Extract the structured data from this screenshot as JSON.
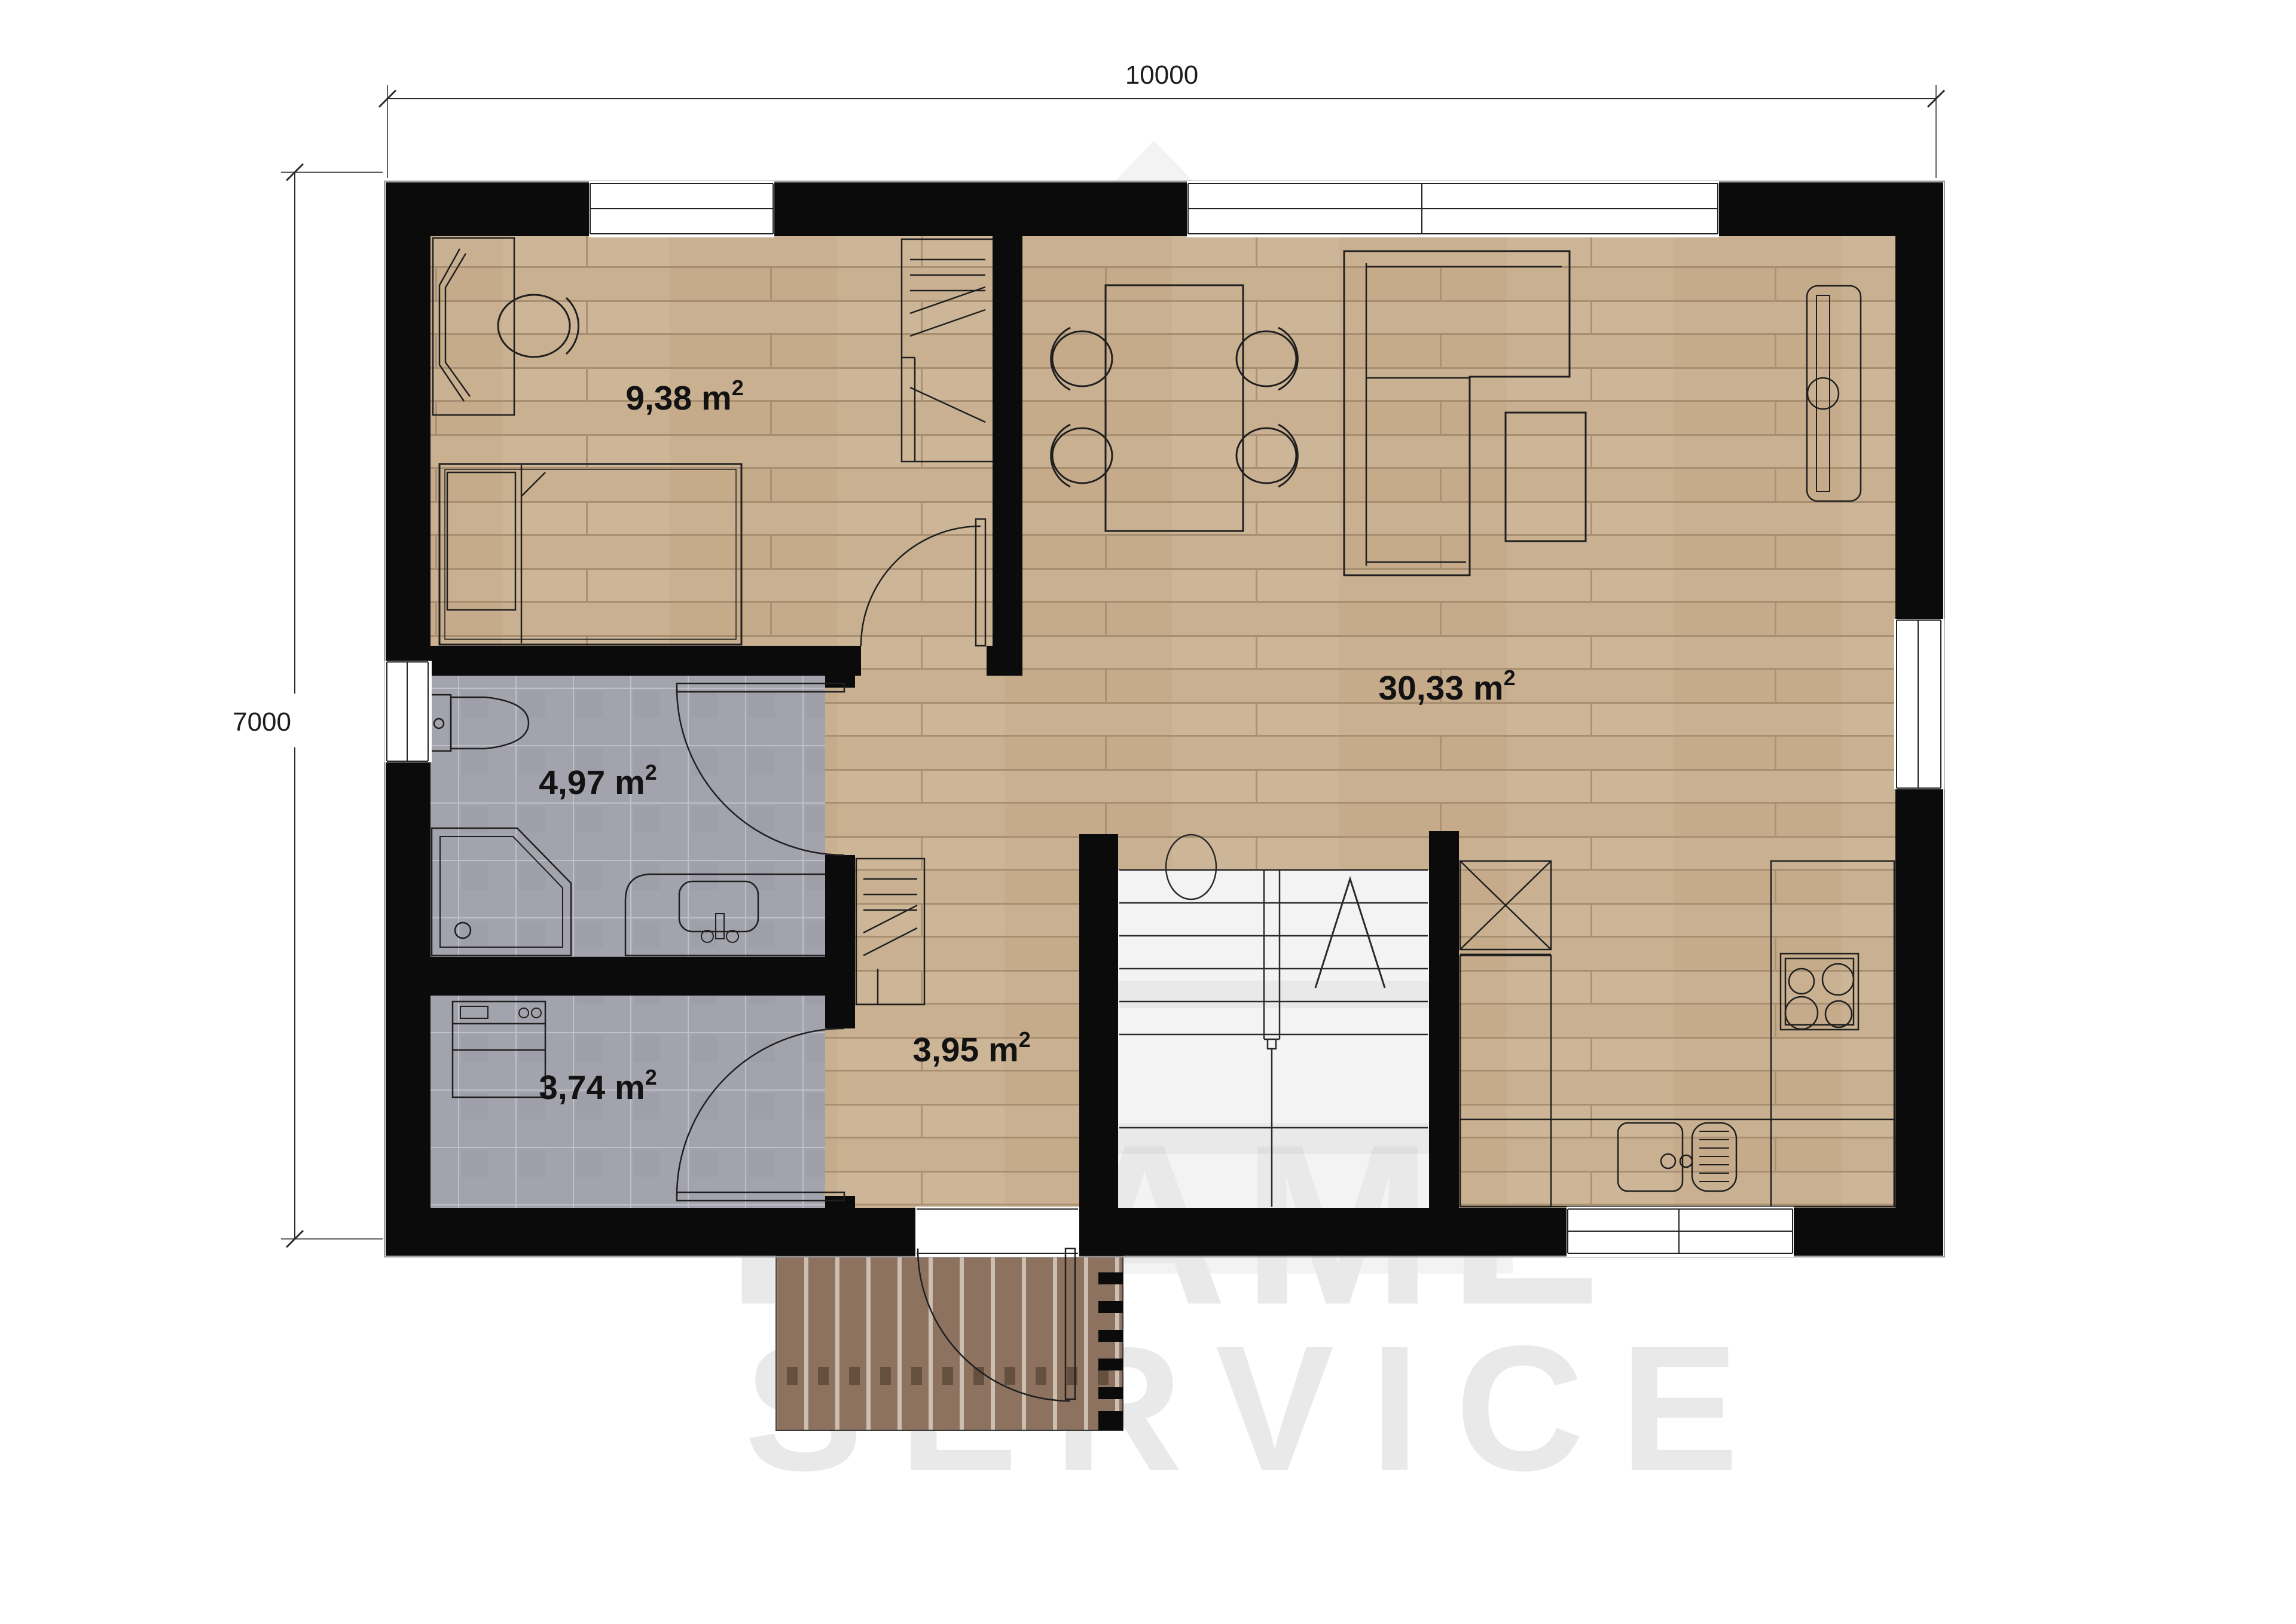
{
  "plan": {
    "type": "floor-plan",
    "rooms": {
      "bedroom": {
        "area": "9,38 m",
        "sup": "2"
      },
      "living_room": {
        "area": "30,33 m",
        "sup": "2"
      },
      "bathroom": {
        "area": "4,97 m",
        "sup": "2"
      },
      "utility": {
        "area": "3,74 m",
        "sup": "2"
      },
      "hall": {
        "area": "3,95 m",
        "sup": "2"
      }
    },
    "dimensions": {
      "top_label": "10000",
      "left_label": "7000"
    }
  },
  "watermark": {
    "line1": "FRAME",
    "line2": "SERVICE"
  },
  "colors": {
    "wall": "#0b0b0b",
    "wood_floor": "#c9b091",
    "tile_floor": "#a3a3ad",
    "deck_plank": "#8d7260",
    "furniture_line": "#1f1f1f",
    "dimension_line": "#2a2a2a",
    "watermark_text": "#e9e9e9",
    "watermark_house": "#f3f3f3"
  }
}
